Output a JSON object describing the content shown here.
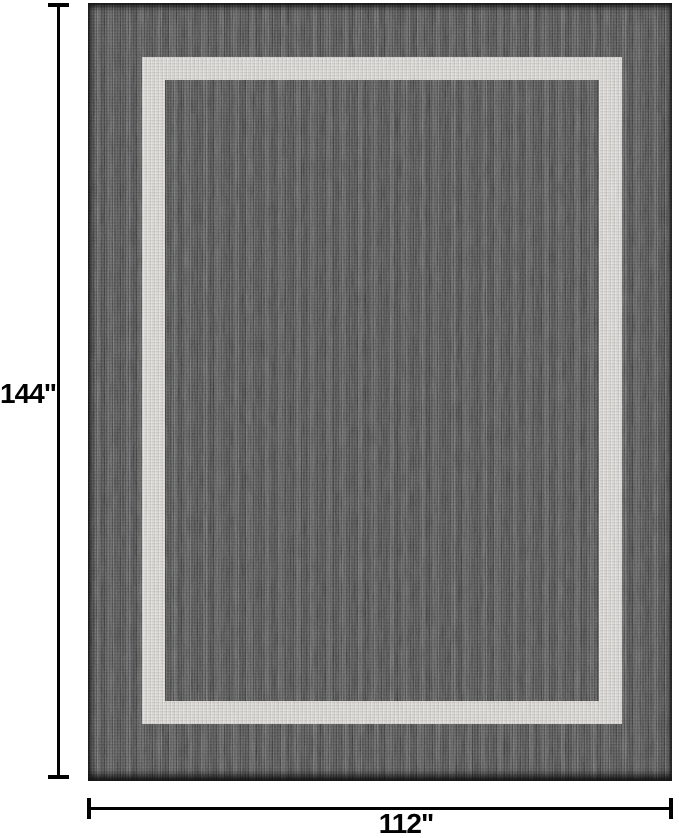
{
  "figure": {
    "labels": {
      "height": "144\"",
      "width": "112\""
    }
  },
  "colors": {
    "background": "#ffffff",
    "rug_field": "#4e4e4e",
    "rug_stripe": "#d8d6d1",
    "rug_edge": "#262626",
    "dimension_line": "#000000",
    "label_text": "#000000"
  }
}
